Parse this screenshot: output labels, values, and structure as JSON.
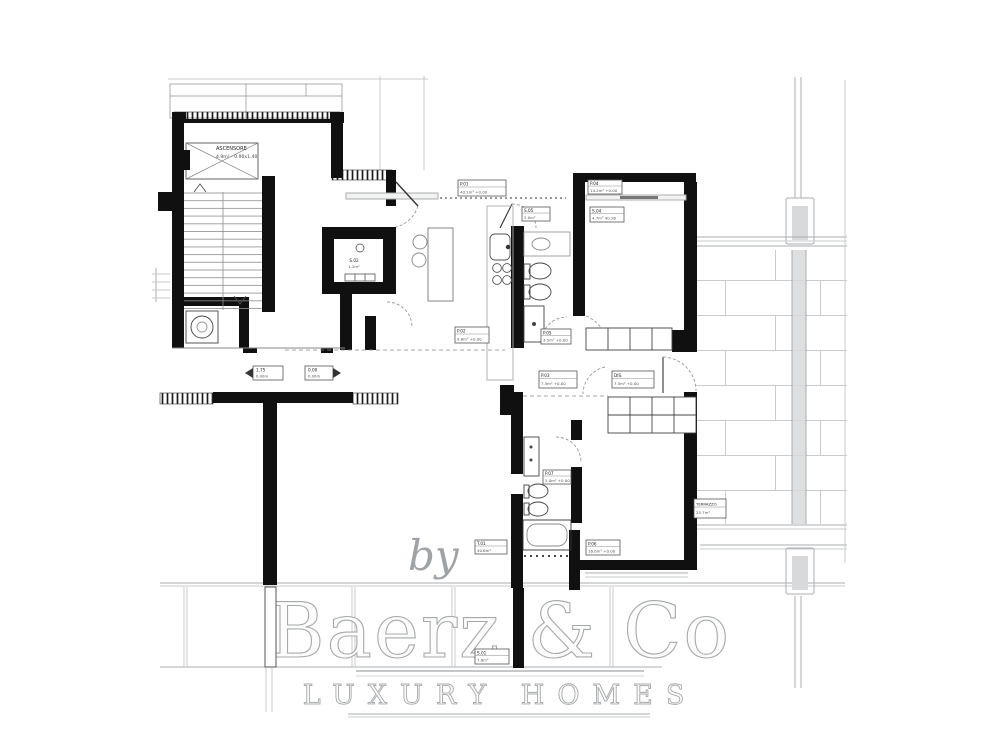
{
  "meta": {
    "type": "architectural-floor-plan"
  },
  "colors": {
    "paper": "#ffffff",
    "wall": "#101010",
    "thin_line": "#a9adaf",
    "light_line": "#c9cccd",
    "fixture_line": "#555555",
    "watermark_fill": "#fcfcfc",
    "watermark_edge": "#a6a9ab",
    "watermark_gray": "#9fa3a5"
  },
  "watermark": {
    "by": "by",
    "brand": "Baerz & Co",
    "tagline": "LUXURY HOMES"
  },
  "labels": {
    "elevator": {
      "l1": "ASCENSORE",
      "l2": "4.9m² - 0.90x1.40"
    },
    "living": {
      "l1": "P.01",
      "l2": "40.2m²  +0.00"
    },
    "kitchen": {
      "l1": "P.02",
      "l2": "9.6m²  +0.00"
    },
    "hall": {
      "l1": "P.03",
      "l2": "7.5m²  +0.00"
    },
    "hall2": {
      "l1": "DIS.",
      "l2": "7.5m²  +0.00"
    },
    "bed1": {
      "l1": "P.04",
      "l2": "14.2m²  +0.00"
    },
    "bed1b": {
      "l1": "S.04",
      "l2": "4.7m²  40.26"
    },
    "bath1": {
      "l1": "P.05",
      "l2": "3.5m²  +0.00"
    },
    "bathv": {
      "l1": "S.05",
      "l2": "2.0m²"
    },
    "bath2": {
      "l1": "P.07",
      "l2": "5.0m²  +0.00"
    },
    "bed2": {
      "l1": "P.06",
      "l2": "16.0m²  +0.00"
    },
    "terr1": {
      "l1": "T.01",
      "l2": "40.6m²"
    },
    "terr2": {
      "l1": "S.01",
      "l2": "7.8m²"
    },
    "store": {
      "l1": "S.02",
      "l2": "1.2m²"
    },
    "terrace": {
      "l1": "TERRAZZO",
      "l2": "25.7m²"
    },
    "lvl1": {
      "l1": "1.75",
      "l2": "0.00m"
    },
    "lvl2": {
      "l1": "0.00",
      "l2": "0.00m"
    }
  }
}
